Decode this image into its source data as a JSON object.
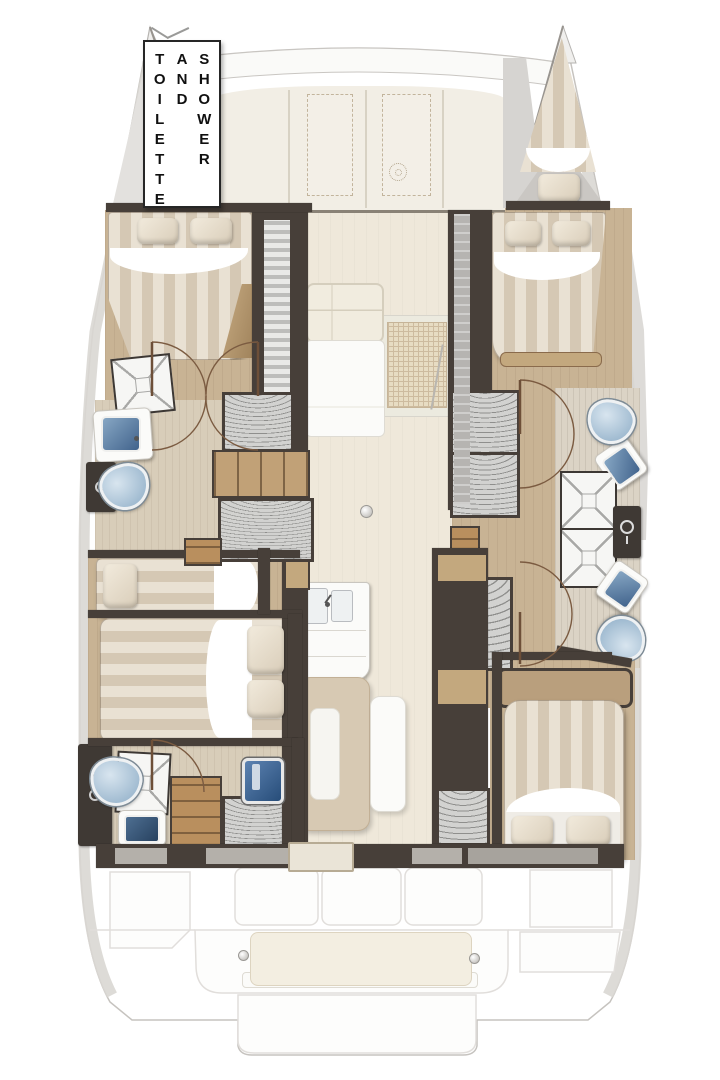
{
  "sign": {
    "words": [
      "TOILETTE",
      "AND",
      "SHOWER"
    ]
  },
  "diagram": {
    "type": "yacht-floor-plan",
    "vessel": "catamaran",
    "view": "top-down deck plan"
  },
  "inventory": {
    "double_berths": 4,
    "bow_berths_visible": 1,
    "single_berths": 1,
    "toilets": 4,
    "bathroom_sinks": 4,
    "shower_pans": 4,
    "galley_sink": 1,
    "dining_table": 1,
    "salon_sofa": 1,
    "cockpit_bench": 1,
    "deck_hatches": 2
  },
  "icons": {
    "windlass": "dotted-circle",
    "keyhole": "ring",
    "cabinet_handle": "ring-and-bar",
    "faucet": "dot-and-stick"
  },
  "palette": {
    "hull_outline": "#c6c3bf",
    "side_deck_gray": "#d8d5d1",
    "cabin_top_cream": "#f2eee5",
    "interior_wall_dark": "#473f39",
    "wood_floor": "#c8b394",
    "salon_floor": "#efe8da",
    "mattress_stripe_light": "#e9e1d3",
    "mattress_stripe_dark": "#d5c8b4",
    "pillow_cream": "#ece3d2",
    "toilet_blue": "#9fbad0",
    "sink_basin_blue": "#41638c",
    "washer_hatch_blue": "#3f66a0",
    "locker_gray": "#d2d2d0",
    "cockpit_bench_cream": "#f3eee0",
    "sign_border": "#262626",
    "sign_text": "#101010"
  }
}
